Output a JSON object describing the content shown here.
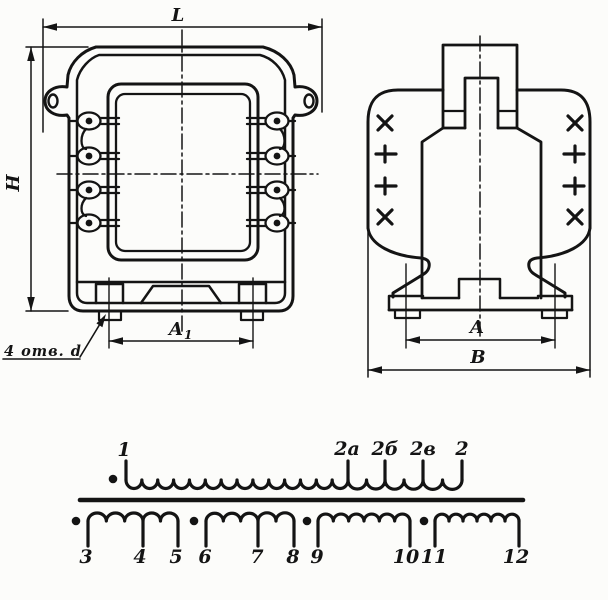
{
  "front_view": {
    "dim_length": "L",
    "dim_height": "H",
    "dim_hole_pitch": "A",
    "dim_hole_pitch_sub": "1",
    "holes_note": "4 отв. d"
  },
  "side_view": {
    "dim_foot_pitch": "A",
    "dim_width": "В"
  },
  "schematic": {
    "primary": {
      "start": "1",
      "tap_a": "2а",
      "tap_b": "2б",
      "tap_c": "2в",
      "end": "2"
    },
    "secondary": {
      "t3": "3",
      "t4": "4",
      "t5": "5",
      "t6": "6",
      "t7": "7",
      "t8": "8",
      "t9": "9",
      "t10": "10",
      "t11": "11",
      "t12": "12"
    }
  }
}
